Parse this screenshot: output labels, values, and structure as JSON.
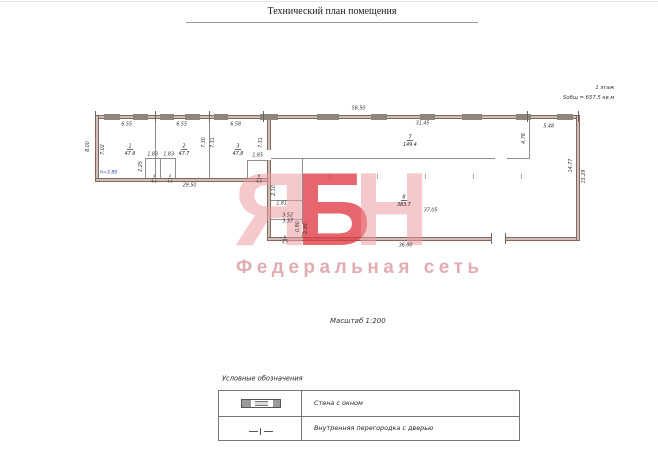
{
  "header": {
    "title": "Технический план помещения"
  },
  "info": {
    "floor": "1 этаж",
    "total_area": "Sобщ = 657.5 кв.м",
    "scale": "Масштаб 1:200",
    "height_note": "h=3.80"
  },
  "rooms": [
    {
      "num": "1",
      "area": "47.9"
    },
    {
      "num": "2",
      "area": "47.7"
    },
    {
      "num": "3",
      "area": "47.8"
    },
    {
      "num": "4",
      "area": "4.1"
    },
    {
      "num": "5",
      "area": "4.1"
    },
    {
      "num": "6",
      "area": "4.2"
    },
    {
      "num": "7",
      "area": "149.4"
    },
    {
      "num": "8",
      "area": "383.7"
    },
    {
      "num": "9",
      "area": "4.7"
    }
  ],
  "dims": {
    "total_top": "58.50",
    "r1": "6.55",
    "r2": "6.55",
    "r3": "6.58",
    "left_outer": "8.00",
    "left_inner": "7.02",
    "h1": "7.30",
    "h2": "7.31",
    "h3": "7.31",
    "wc1": "1.83",
    "wc2": "1.83",
    "wc_depth": "2.25",
    "wc3": "1.85",
    "bottom_left": "29.50",
    "r7_width": "31.45",
    "r7_wall": "4.78",
    "top_right": "5.48",
    "right_inner": "14.77",
    "right_outer": "15.29",
    "mid_width": "37.05",
    "bottom_right": "36.00",
    "m1": "1.81",
    "m2": "3.52",
    "m3": "3.37",
    "m4": "0.90",
    "m5": "2.95",
    "m6": "2.10"
  },
  "watermark": {
    "l1": "Я",
    "l2": "Б",
    "l3": "Н",
    "subtitle": "Федеральная сеть"
  },
  "legend": {
    "title": "Условные обозначения",
    "row1": "Стена с окном",
    "row2": "Внутренняя перегородка с дверью"
  },
  "colors": {
    "wall_fill": "#c9c1ba",
    "wall_edge": "#8a655c",
    "partition": "#8f8f8f",
    "watermark_pink": "#ec9aa0",
    "watermark_red": "#e03a42",
    "note_blue": "#2b35b5"
  }
}
